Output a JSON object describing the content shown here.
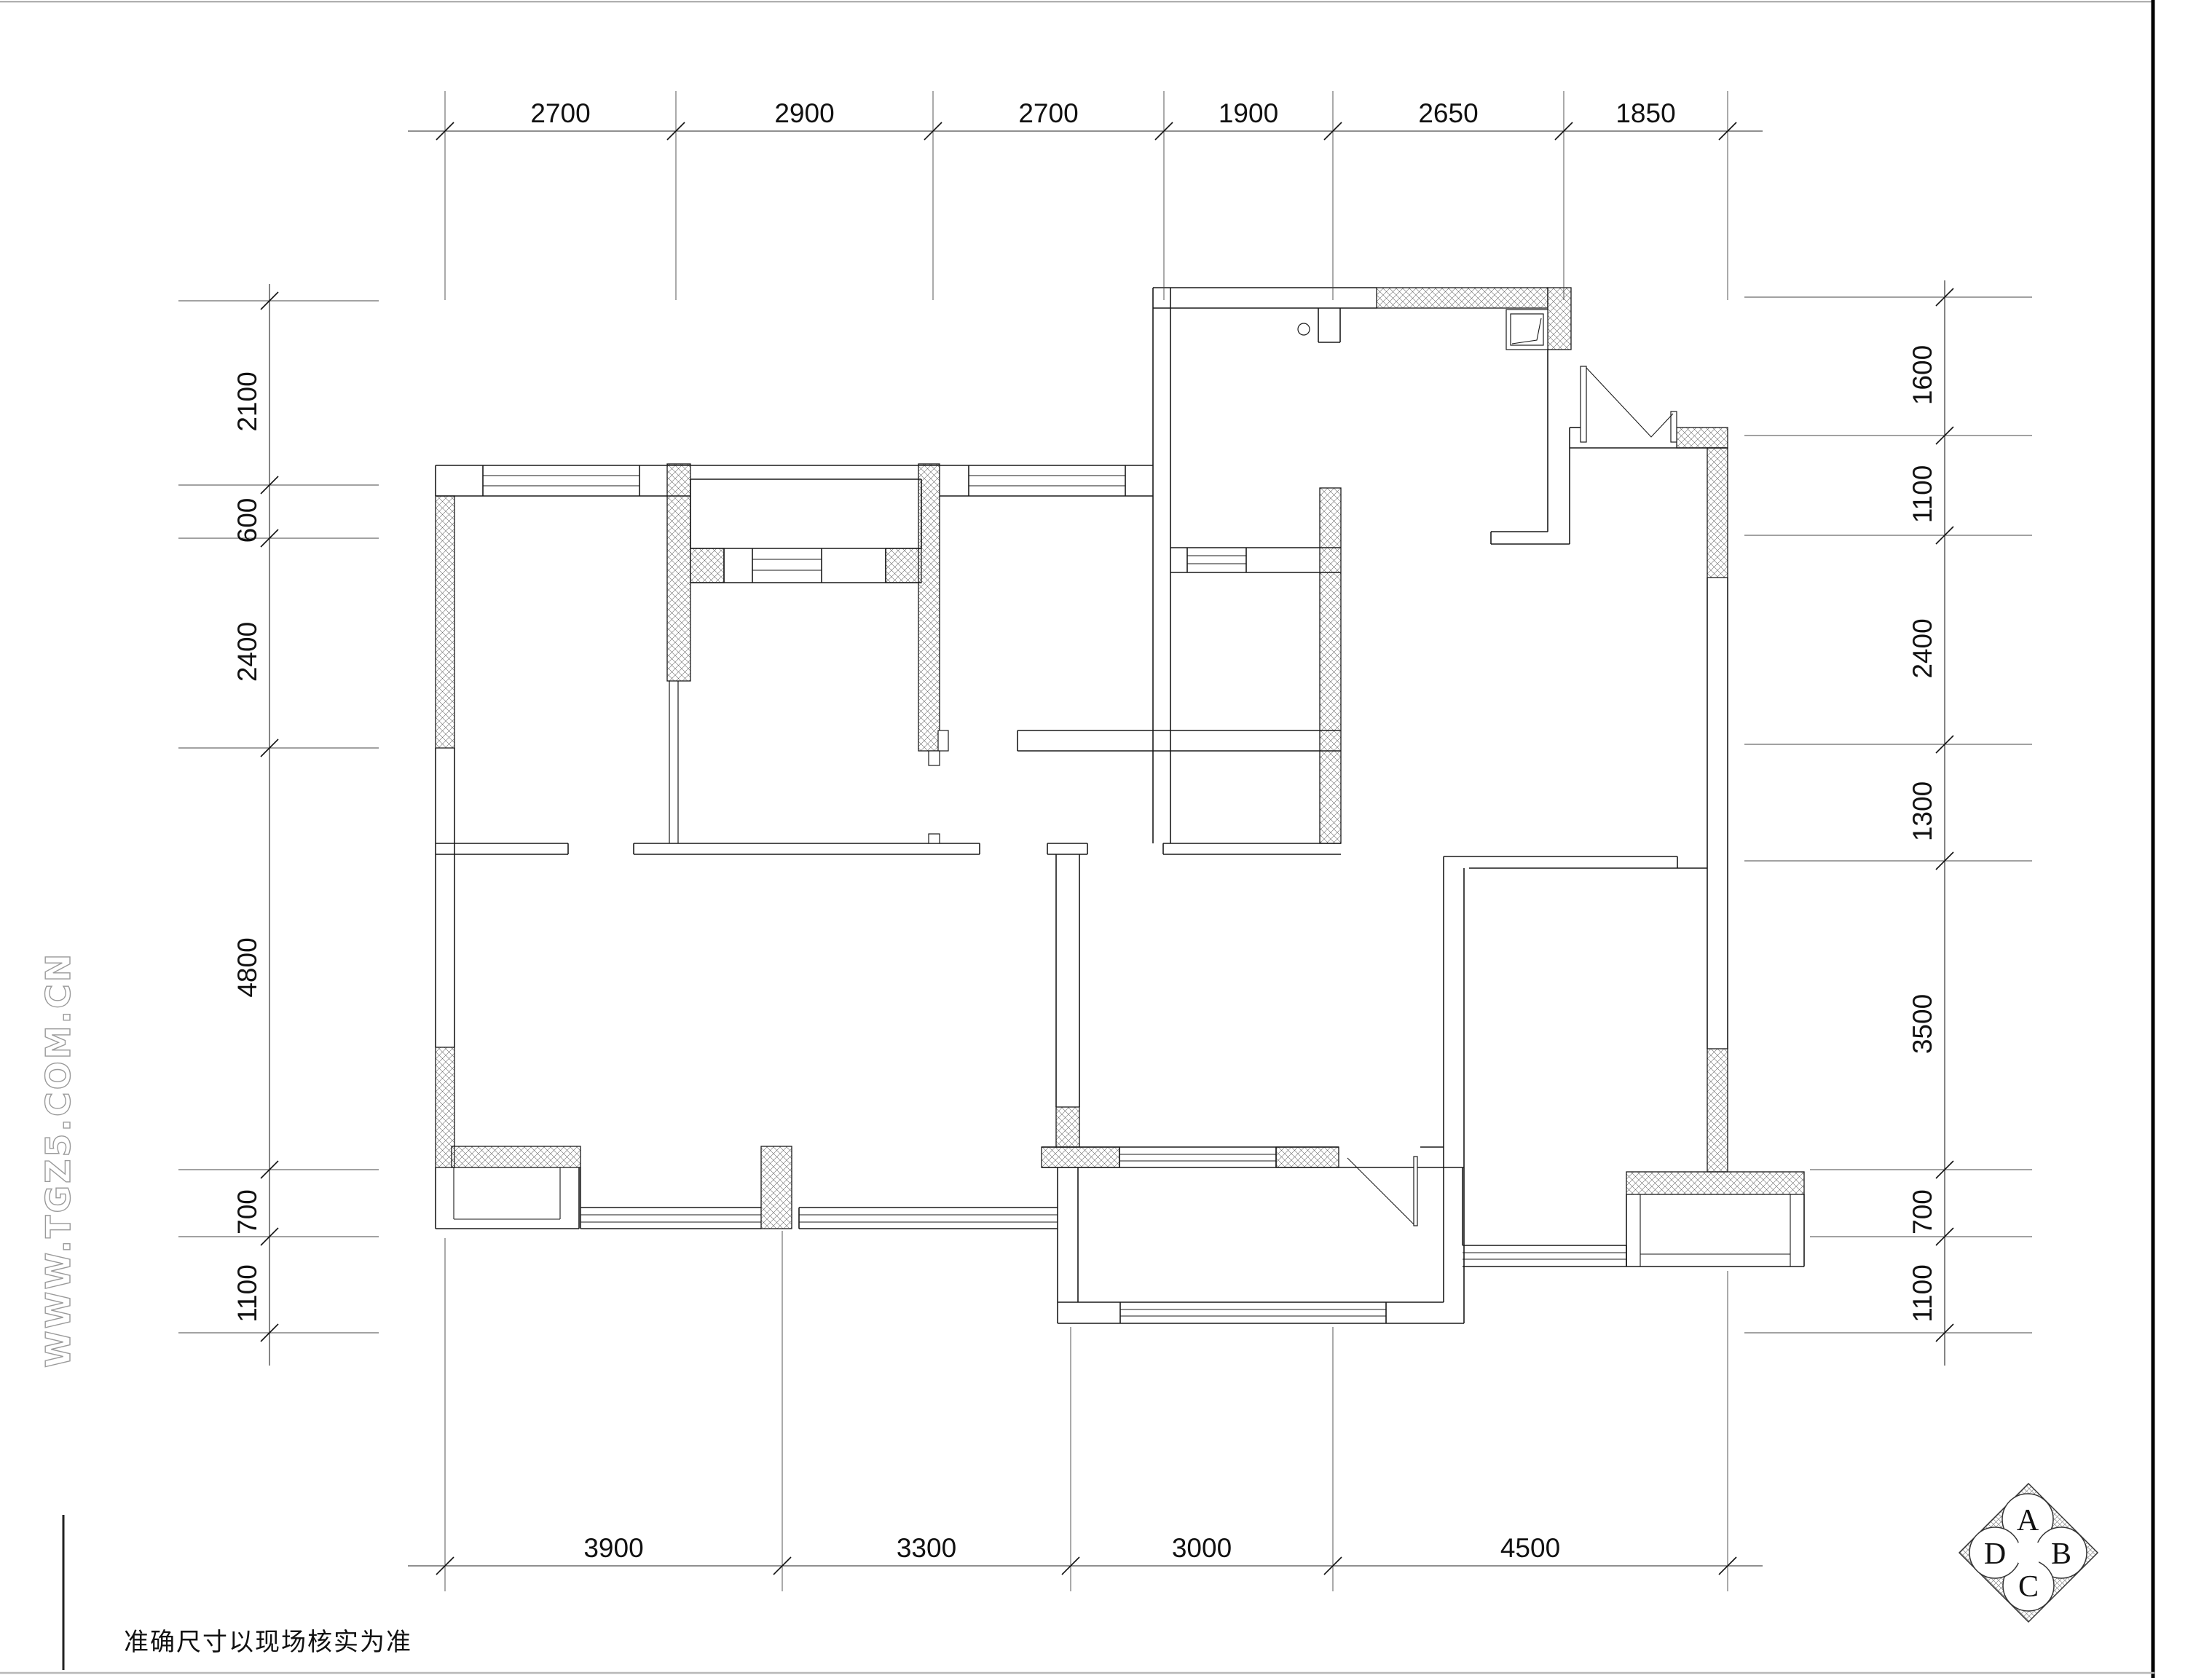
{
  "title": "floor-plan-drawing",
  "dimensions": {
    "top": [
      "2700",
      "2900",
      "2700",
      "1900",
      "2650",
      "1850"
    ],
    "bottom": [
      "3900",
      "3300",
      "3000",
      "4500"
    ],
    "left": [
      "2100",
      "600",
      "2400",
      "4800",
      "700",
      "1100"
    ],
    "right": [
      "1600",
      "1100",
      "2400",
      "1300",
      "3500",
      "700",
      "1100"
    ]
  },
  "notes": {
    "bottom_left": "准确尺寸以现场核实为准"
  },
  "watermark": {
    "text": "WWW.TGZ5.COM.CN"
  },
  "logo": {
    "letters": [
      "A",
      "B",
      "C",
      "D"
    ]
  },
  "colors": {
    "line": "#1a1a1a",
    "hatch": "#6b6b6b",
    "watermark": "#9a9a9a",
    "border_right": "#000000",
    "border_bottom": "#b8b8b8"
  }
}
